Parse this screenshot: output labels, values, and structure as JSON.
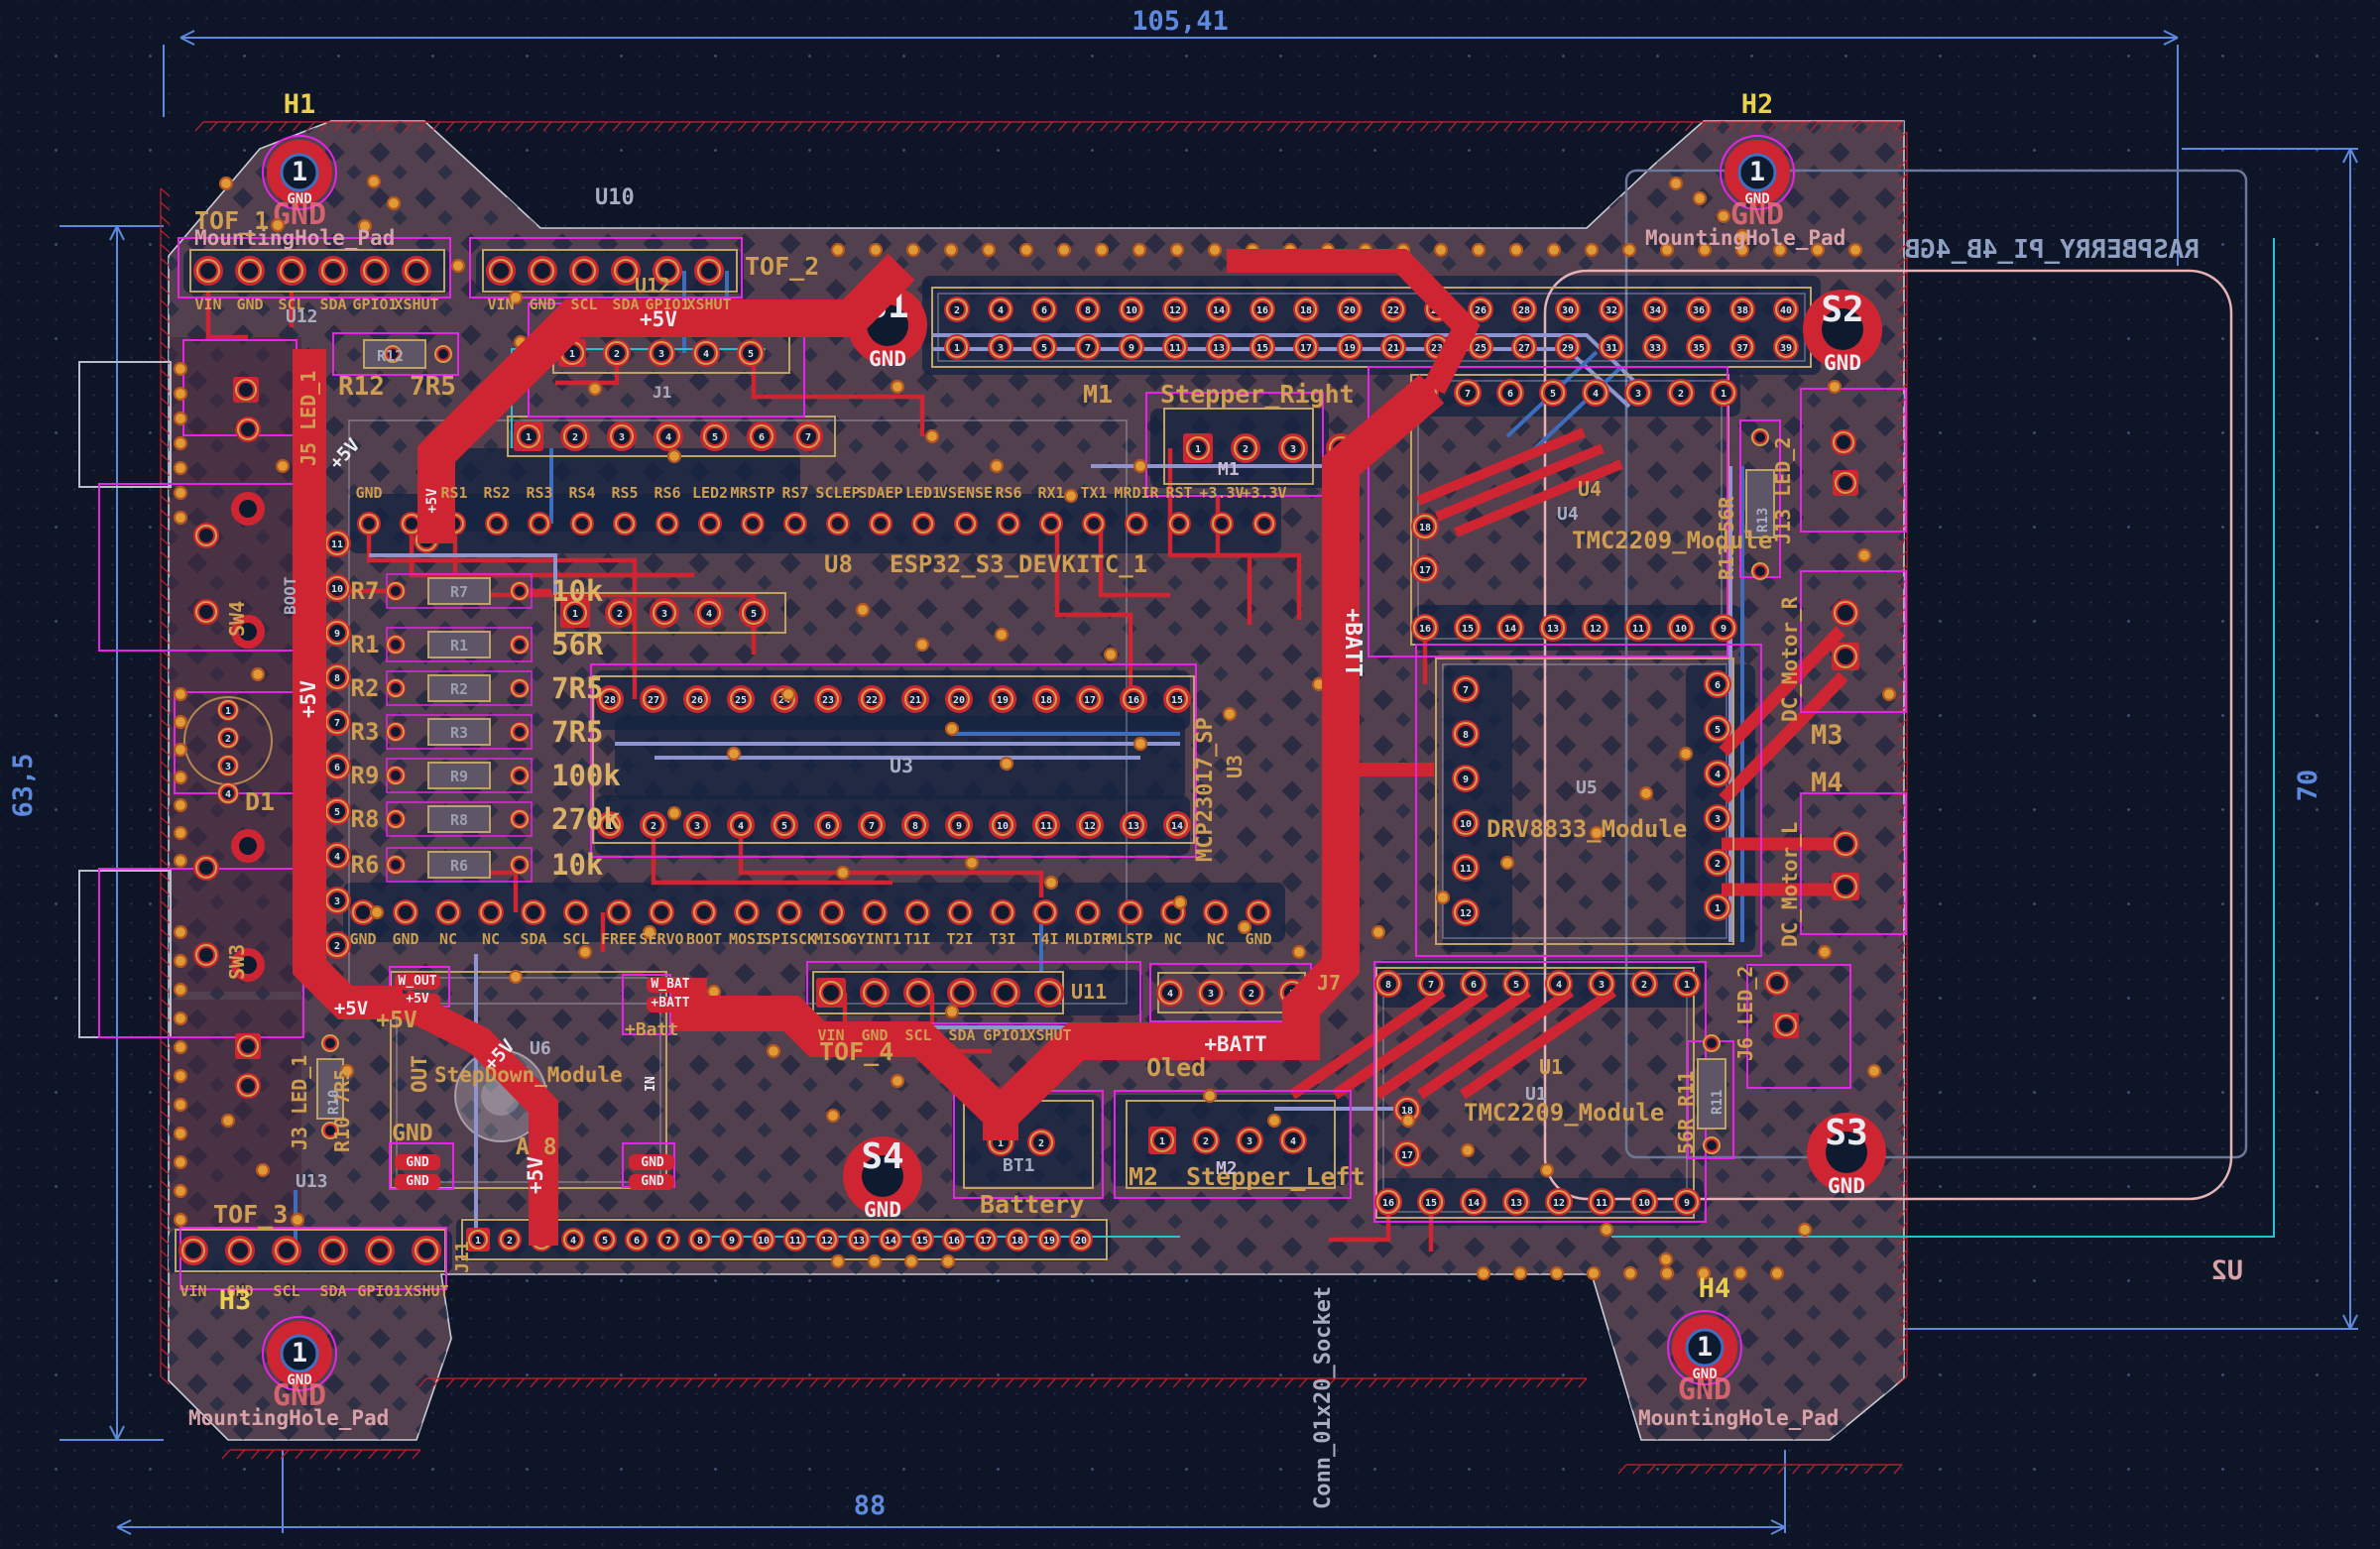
{
  "dimensions": {
    "top": "105,41",
    "bottom": "88",
    "left": "63,5",
    "right": "70"
  },
  "holes": {
    "h1": {
      "ref": "H1"
    },
    "h2": {
      "ref": "H2"
    },
    "h3": {
      "ref": "H3"
    },
    "h4": {
      "ref": "H4"
    },
    "pad": "1",
    "net": "GND",
    "value": "MountingHole_Pad"
  },
  "spads": {
    "s1": "S1",
    "s2": "S2",
    "s3": "S3",
    "s4": "S4",
    "net": "GND"
  },
  "nets": {
    "p5": "+5V",
    "pb": "+BATT",
    "gnd": "GND",
    "wout": "W_OUT",
    "wbat": "W_BAT",
    "in": "IN"
  },
  "silk": {
    "tof1": "TOF_1",
    "tof2": "TOF_2",
    "tof3": "TOF_3",
    "tof4": "TOF_4",
    "u10": "U10",
    "u12a": "U12",
    "u12b": "U12",
    "j1g": "J1",
    "u8": "U8",
    "esp32": "ESP32_S3_DEVKITC_1",
    "u3g": "U3",
    "mcp": "MCP23017_SP",
    "u3v": "U3",
    "j5": "J5 LED_1",
    "j3": "J3 LED_1",
    "j13": "J13 LED_2",
    "j6": "J6 LED_2",
    "r12a": "R12",
    "r12b": "7R5",
    "r13": "R13 56R",
    "r13g": "R13",
    "r11": "56R R11",
    "r11g": "R11",
    "r10": "R10 7R5",
    "r10g": "R10",
    "sw3": "SW3",
    "sw4": "SW4",
    "bootg": "BOOT",
    "d1": "D1",
    "m1a": "M1",
    "m1b": "Stepper_Right",
    "m1g": "M1",
    "m2a": "M2",
    "m2b": "Stepper_Left",
    "m2g": "M2",
    "u4": "U4",
    "u4g": "U4",
    "tmc": "TMC2209_Module",
    "u1": "U1",
    "u1g": "U1",
    "tmc1": "TMC2209_Module",
    "u5g": "U5",
    "drv": "DRV8833_Module",
    "u6": "U6",
    "stepdown": "StepDown_Module",
    "out": "OUT",
    "a8": "A 8",
    "pbatt": "+Batt",
    "bt1": "BT1",
    "battery": "Battery",
    "oled": "Oled",
    "j7": "J7",
    "u11": "U11",
    "j11": "J11",
    "u13": "U13",
    "dcr": "DC_Motor_R",
    "dcl": "DC_Motor_L",
    "m3": "M3",
    "m4": "M4",
    "rpi": "RASPBERRY_PI_4B_4GB",
    "u2": "U2",
    "conn20": "Conn_01x20_Socket"
  },
  "pins": {
    "tof": [
      "VIN",
      "GND",
      "SCL",
      "SDA",
      "GPIO1",
      "XSHUT"
    ],
    "esp_top": [
      "GND",
      "",
      "RS1",
      "RS2",
      "RS3",
      "RS4",
      "RS5",
      "RS6",
      "LED2",
      "MRSTP",
      "RS7",
      "SCLEP",
      "SDAEP",
      "LED1",
      "VSENSE",
      "RS6",
      "RX1",
      "TX1",
      "MRDIR",
      "RST",
      "+3.3V",
      "+3.3V"
    ],
    "esp_bottom": [
      "GND",
      "GND",
      "NC",
      "NC",
      "SDA",
      "SCL",
      "FREE",
      "SERVO",
      "BOOT",
      "MOSI",
      "SPISCK",
      "MISO",
      "GYINT1",
      "T1I",
      "T2I",
      "T3I",
      "T4I",
      "MLDIR",
      "MLSTP",
      "NC",
      "NC",
      "GND"
    ]
  },
  "resistors": [
    {
      "ref": "R7",
      "value": "10k"
    },
    {
      "ref": "R1",
      "value": "56R"
    },
    {
      "ref": "R2",
      "value": "7R5"
    },
    {
      "ref": "R3",
      "value": "7R5"
    },
    {
      "ref": "R9",
      "value": "100k"
    },
    {
      "ref": "R8",
      "value": "270k"
    },
    {
      "ref": "R6",
      "value": "10k"
    }
  ]
}
